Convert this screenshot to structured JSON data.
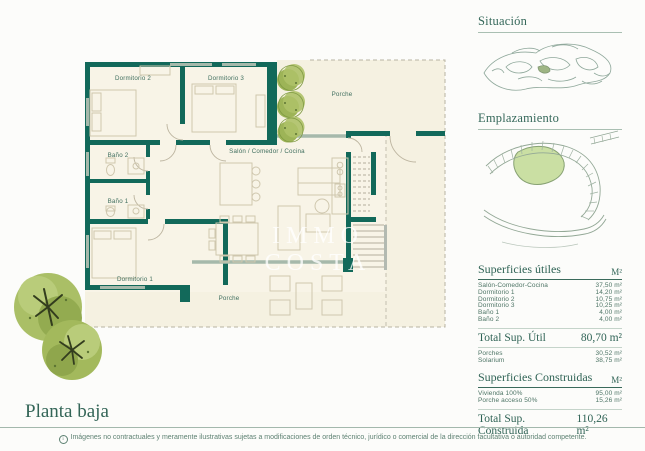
{
  "plan": {
    "title": "Planta baja",
    "watermark": {
      "line1": "IMMO",
      "line2": "COSTA"
    },
    "rooms": {
      "dormitorio2": "Dormitorio 2",
      "dormitorio3": "Dormitorio 3",
      "porche_top": "Porche",
      "bano2": "Baño 2",
      "bano1": "Baño 1",
      "salon": "Salón / Comedor / Cocina",
      "dormitorio1": "Dormitorio 1",
      "porche_bottom": "Porche"
    }
  },
  "sidebar": {
    "situacion_title": "Situación",
    "emplazamiento_title": "Emplazamiento",
    "tables": {
      "utiles": {
        "title": "Superficies útiles",
        "unit": "M²",
        "rows": [
          {
            "label": "Salón-Comedor-Cocina",
            "value": "37,50 m²"
          },
          {
            "label": "Dormitorio 1",
            "value": "14,20 m²"
          },
          {
            "label": "Dormitorio 2",
            "value": "10,75 m²"
          },
          {
            "label": "Dormitorio 3",
            "value": "10,25 m²"
          },
          {
            "label": "Baño 1",
            "value": "4,00 m²"
          },
          {
            "label": "Baño 2",
            "value": "4,00 m²"
          }
        ],
        "total_label": "Total Sup. Útil",
        "total_value": "80,70 m²",
        "extra_rows": [
          {
            "label": "Porches",
            "value": "30,52 m²"
          },
          {
            "label": "Solarium",
            "value": "38,75 m²"
          }
        ]
      },
      "construidas": {
        "title": "Superficies Construidas",
        "unit": "M²",
        "rows": [
          {
            "label": "Vivienda 100%",
            "value": "95,00 m²"
          },
          {
            "label": "Porche acceso 50%",
            "value": "15,26 m²"
          }
        ],
        "total_label": "Total Sup. Construida",
        "total_value": "110,26 m²"
      }
    }
  },
  "footer": {
    "info_icon": "i",
    "disclaimer": "Imágenes no contractuales y meramente ilustrativas sujetas a modificaciones de orden técnico, jurídico o comercial de la dirección facultativa o autoridad competente."
  },
  "colors": {
    "wall_teal": "#12695a",
    "heading_green": "#35685a",
    "floor_cream": "#f8f4e7",
    "plot_green": "#cadfa3"
  }
}
